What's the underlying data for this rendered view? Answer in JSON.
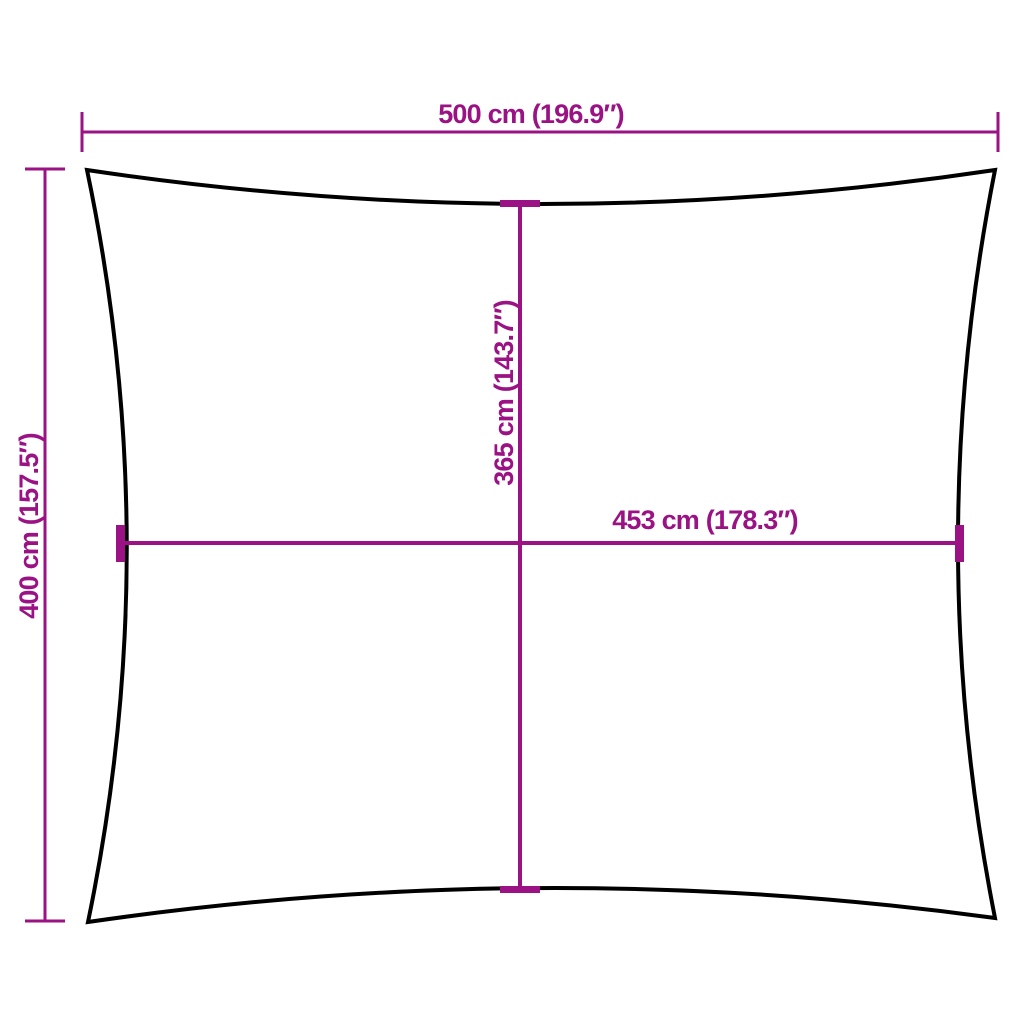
{
  "colors": {
    "dimension": "#9A1283",
    "outline": "#000000",
    "background": "#FFFFFF"
  },
  "dimensions": {
    "overall_width": {
      "label": "500 cm (196.9″)",
      "cm": 500,
      "inches": 196.9
    },
    "overall_height": {
      "label": "400 cm (157.5″)",
      "cm": 400,
      "inches": 157.5
    },
    "inner_height": {
      "label": "365 cm (143.7″)",
      "cm": 365,
      "inches": 143.7
    },
    "inner_width": {
      "label": "453 cm (178.3″)",
      "cm": 453,
      "inches": 178.3
    }
  }
}
